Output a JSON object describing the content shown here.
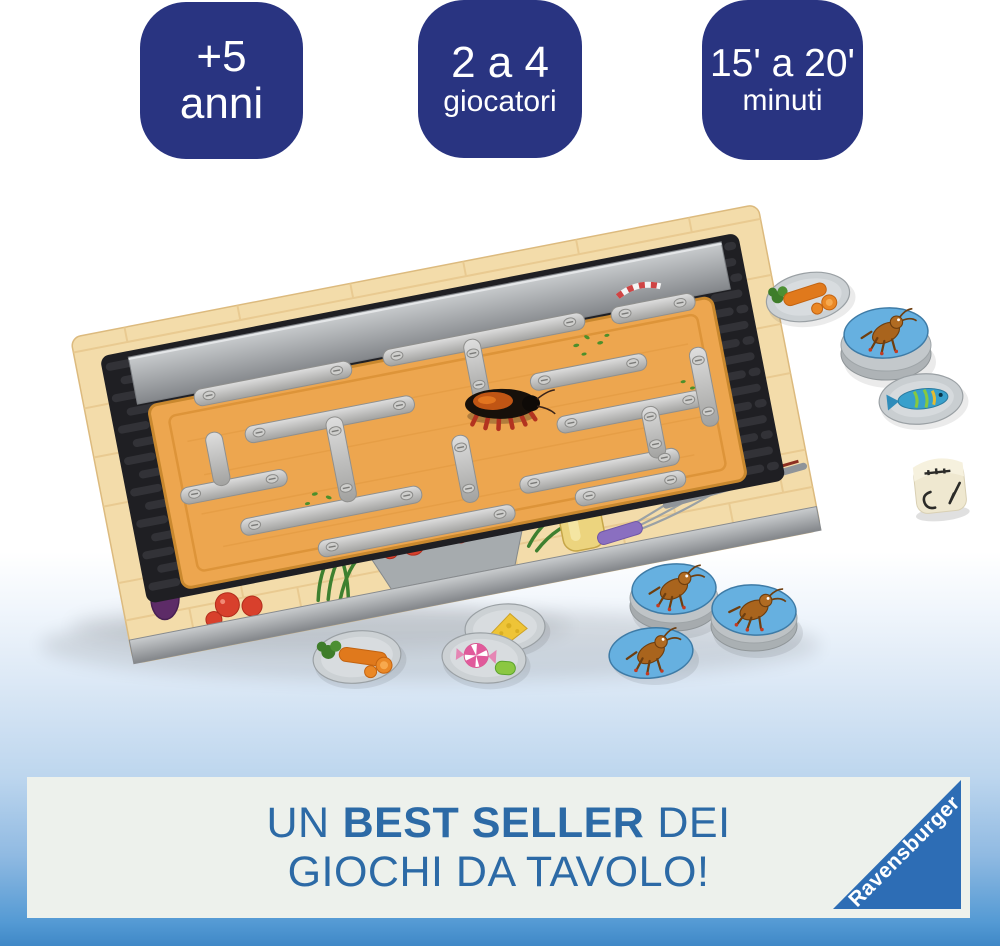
{
  "badges": [
    {
      "id": "age",
      "line1": "+5",
      "line2": "anni"
    },
    {
      "id": "players",
      "line1": "2 a 4",
      "line2": "giocatori"
    },
    {
      "id": "duration",
      "line1": "15' a 20'",
      "line2": "minuti"
    }
  ],
  "badge_style": {
    "bg": "#293481",
    "text": "#ffffff"
  },
  "banner": {
    "line1_pre": "UN",
    "line1_bold": "BEST SELLER",
    "line1_post": "DEI",
    "line2": "GIOCHI DA TAVOLO!",
    "text_color": "#2c6aa6",
    "panel_bg": "#edf1ec"
  },
  "brand": {
    "name": "Ravensburger",
    "triangle_color": "#2d6db5",
    "text_color": "#ffffff"
  },
  "background_band": {
    "top_color": "#dde9f6",
    "bottom_color": "#3f88c7"
  },
  "photo_icons": [
    "game-box",
    "cutlery-maze",
    "cockroach-robot",
    "cutting-board",
    "cockroach-token",
    "carrot-token",
    "fish-token",
    "cheese-token",
    "candy-token",
    "symbol-die"
  ]
}
